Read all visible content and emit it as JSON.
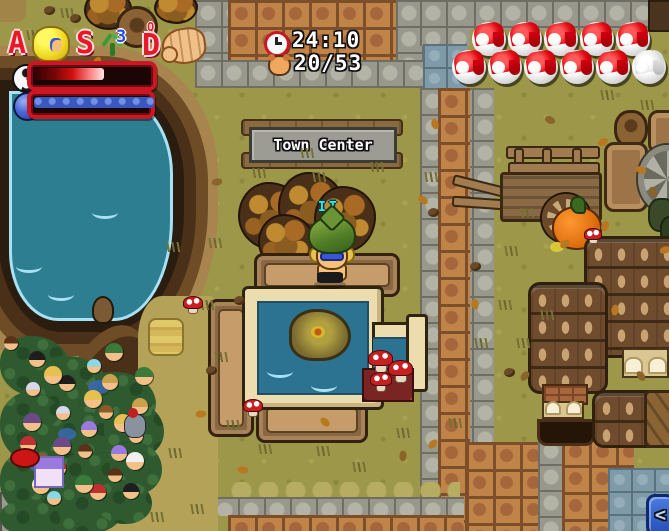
{
  "colors": {
    "grass": "#9d9749",
    "path_stone": "#98988c",
    "path_brick": "#b9793f",
    "tile_blue": "#7f9aa8",
    "water": "#2e7e92",
    "water_edge": "#a8e0f4",
    "cliff": "#5e3e20",
    "wood": "#8a6743",
    "roof": "#6f4c2e",
    "bush": "#2f5a30",
    "hud_frame_red": "#cc1624",
    "hp_fill": "#d01010",
    "mana_fill": "#3a57c0",
    "orb_red": "#e00812",
    "name_cyan": "#35e8e8",
    "sign_panel": "#9c9c94",
    "chat_blue": "#2850b8",
    "pumpkin": "#e07010"
  },
  "hud": {
    "slots": [
      {
        "key": "A",
        "item": "mask-icon"
      },
      {
        "key": "S",
        "item": "slingshot-icon",
        "count": "3"
      },
      {
        "key": "D",
        "item": "glove-icon",
        "badge": "Q"
      }
    ],
    "health": {
      "icon": "yinyang-orb-icon",
      "percent": 57
    },
    "mana": {
      "icon": "blue-orb-icon",
      "percent": 100
    }
  },
  "status": {
    "time": "24:10",
    "time_icon": "clock-icon",
    "counter": "20/53",
    "counter_icon": "player-head-icon"
  },
  "life_orbs": {
    "rows": [
      {
        "full": 5,
        "empty": 0
      },
      {
        "full": 5,
        "empty": 1
      }
    ]
  },
  "sign": {
    "text": "Town Center"
  },
  "player": {
    "name": "IT"
  },
  "chat_toggle": {
    "label": "<"
  },
  "crowd": {
    "count": 30,
    "hair_colors": [
      "#5a3218",
      "#1e1e1e",
      "#e8c050",
      "#8a5a2a",
      "#c03030",
      "#3a7a3a",
      "#d8d8ec",
      "#9a7ade",
      "#f0f0f0",
      "#88d8e8",
      "#caa24e",
      "#6b4a86"
    ]
  }
}
